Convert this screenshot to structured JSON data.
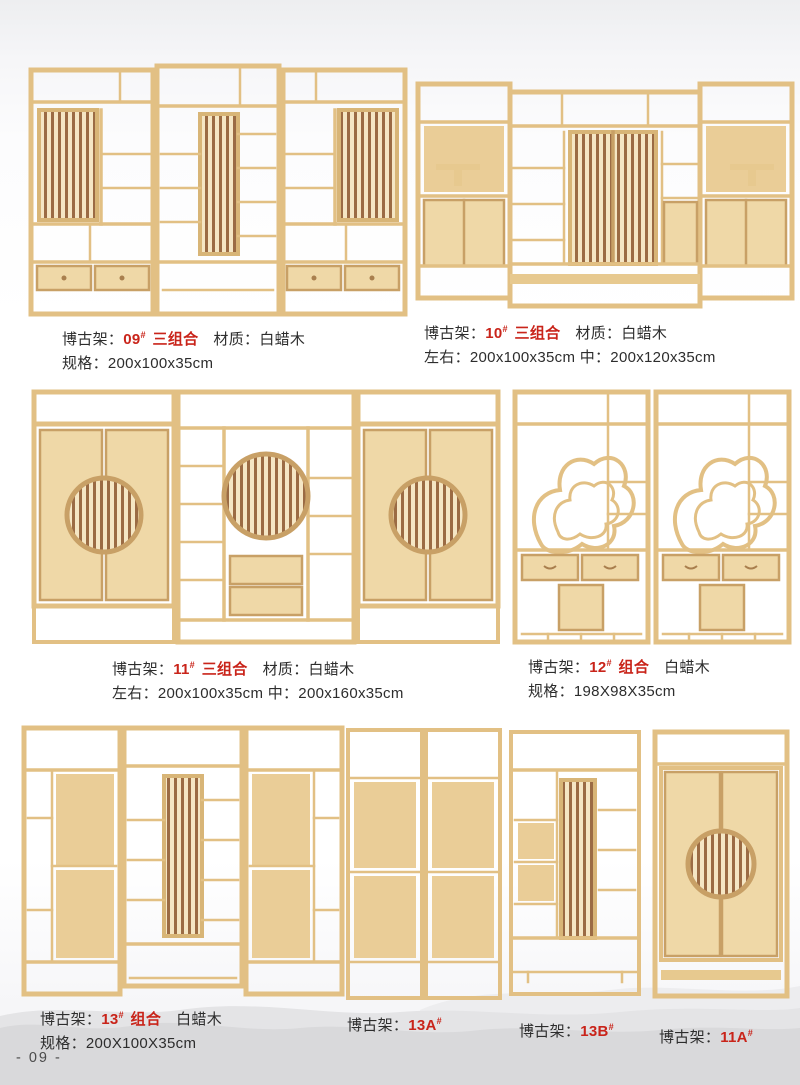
{
  "page": {
    "number_label": "- 09 -"
  },
  "colors": {
    "accent_red": "#c9241a",
    "text": "#2d2d2d",
    "wood_frame": "#e2c084",
    "wood_panel": "#efd8a7",
    "lattice_slat": "#9b6b44",
    "mountain_watermark": "#d9d9db"
  },
  "products": [
    {
      "prefix": "博古架：",
      "code": "09",
      "hash": "#",
      "suffix": "三组合",
      "material": "材质：白蜡木",
      "spec": "规格：200x100x35cm"
    },
    {
      "prefix": "博古架：",
      "code": "10",
      "hash": "#",
      "suffix": "三组合",
      "material": "材质：白蜡木",
      "spec": "左右：200x100x35cm 中：200x120x35cm"
    },
    {
      "prefix": "博古架：",
      "code": "11",
      "hash": "#",
      "suffix": "三组合",
      "material": "材质：白蜡木",
      "spec": "左右：200x100x35cm 中：200x160x35cm"
    },
    {
      "prefix": "博古架：",
      "code": "12",
      "hash": "#",
      "suffix": "组合",
      "material": "白蜡木",
      "spec": "规格：198X98X35cm"
    },
    {
      "prefix": "博古架：",
      "code": "13",
      "hash": "#",
      "suffix": "组合",
      "material": "白蜡木",
      "spec": "规格：200X100X35cm"
    },
    {
      "prefix": "博古架：",
      "code": "13A",
      "hash": "#"
    },
    {
      "prefix": "博古架：",
      "code": "13B",
      "hash": "#"
    },
    {
      "prefix": "博古架：",
      "code": "11A",
      "hash": "#"
    }
  ]
}
